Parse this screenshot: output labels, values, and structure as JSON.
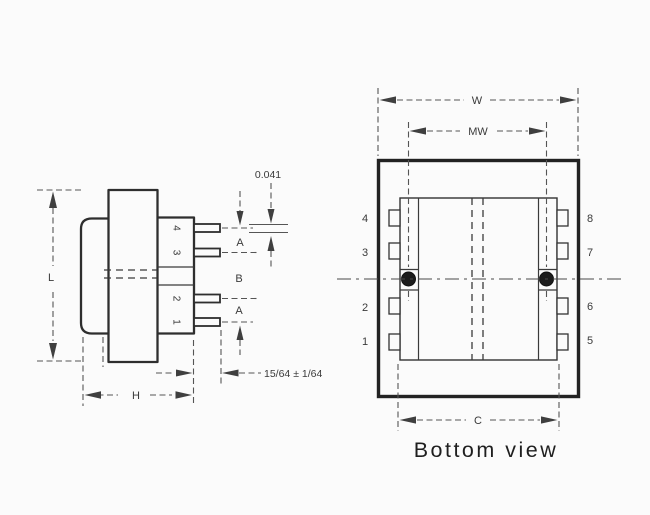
{
  "colors": {
    "background": "#fbfbfb",
    "outline": "#2e2e2e",
    "dimension_line": "#555555",
    "label_text": "#3a3a3a",
    "caption_text": "#1f1f1f",
    "hole_fill": "#1c1c1c"
  },
  "side_view": {
    "dim_l": "L",
    "dim_h": "H",
    "dim_a_top": "A",
    "dim_b": "B",
    "dim_a_bottom": "A",
    "dim_pin_thickness": "0.041",
    "dim_pin_length": "15/64 ± 1/64",
    "pin_numbers": [
      "4",
      "3",
      "2",
      "1"
    ]
  },
  "bottom_view": {
    "dim_w": "W",
    "dim_mw": "MW",
    "dim_c": "C",
    "left_pin_numbers": [
      "4",
      "3",
      "2",
      "1"
    ],
    "right_pin_numbers": [
      "8",
      "7",
      "6",
      "5"
    ],
    "caption": "Bottom view"
  }
}
